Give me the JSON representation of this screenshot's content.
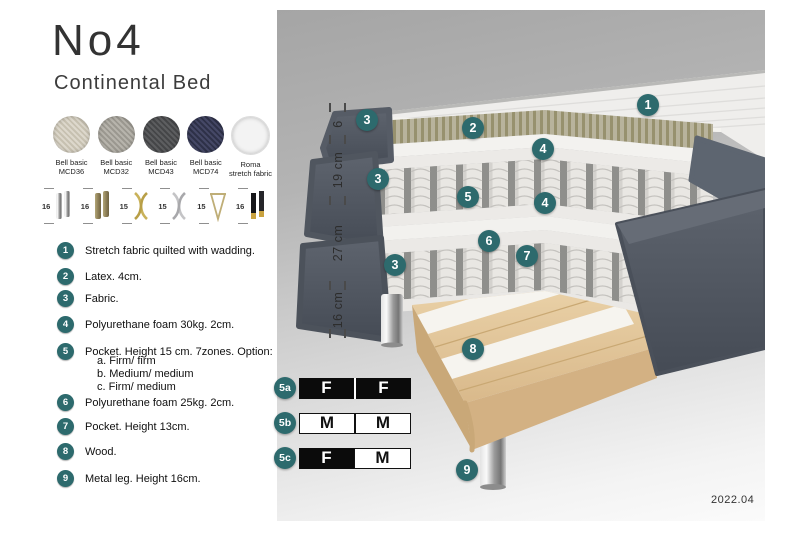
{
  "header": {
    "title": "No4",
    "subtitle": "Continental Bed"
  },
  "fabrics": [
    {
      "line1": "Bell basic",
      "line2": "MCD36",
      "color": "#d9d4c9"
    },
    {
      "line1": "Bell basic",
      "line2": "MCD32",
      "color": "#b2afa8"
    },
    {
      "line1": "Bell basic",
      "line2": "MCD43",
      "color": "#57585a"
    },
    {
      "line1": "Bell basic",
      "line2": "MCD74",
      "color": "#3f4259"
    },
    {
      "line1": "Roma",
      "line2": "stretch fabric",
      "color": "#f3f3f3"
    }
  ],
  "legs": [
    {
      "height": "16",
      "type": "chrome cylinder legs"
    },
    {
      "height": "16",
      "type": "wood cylinder legs"
    },
    {
      "height": "15",
      "type": "gold cross legs"
    },
    {
      "height": "15",
      "type": "silver cross legs"
    },
    {
      "height": "15",
      "type": "hairpin legs"
    },
    {
      "height": "16",
      "type": "black legs with brass tip"
    }
  ],
  "legend": {
    "items": [
      {
        "num": "1",
        "text": "Stretch fabric quilted with wadding."
      },
      {
        "num": "2",
        "text": "Latex. 4cm."
      },
      {
        "num": "3",
        "text": "Fabric."
      },
      {
        "num": "4",
        "text": "Polyurethane foam 30kg. 2cm."
      },
      {
        "num": "5",
        "text": "Pocket. Height 15 cm. 7zones. Option:",
        "options": [
          "a. Firm/ firm",
          "b. Medium/ medium",
          "c. Firm/ medium"
        ]
      },
      {
        "num": "6",
        "text": "Polyurethane foam 25kg. 2cm."
      },
      {
        "num": "7",
        "text": "Pocket. Height 13cm."
      },
      {
        "num": "8",
        "text": "Wood."
      },
      {
        "num": "9",
        "text": "Metal leg. Height 16cm."
      }
    ]
  },
  "illustration": {
    "dimensions": [
      "6",
      "19 cm",
      "27 cm",
      "16 cm"
    ],
    "callouts": [
      "1",
      "3",
      "2",
      "4",
      "3",
      "5",
      "4",
      "6",
      "7",
      "3",
      "8",
      "9"
    ],
    "date": "2022.04"
  },
  "firmness": {
    "rows": [
      {
        "label": "5a",
        "cells": [
          {
            "text": "F",
            "style": "dark"
          },
          {
            "text": "F",
            "style": "dark"
          }
        ]
      },
      {
        "label": "5b",
        "cells": [
          {
            "text": "M",
            "style": "light"
          },
          {
            "text": "M",
            "style": "light"
          }
        ]
      },
      {
        "label": "5c",
        "cells": [
          {
            "text": "F",
            "style": "dark"
          },
          {
            "text": "M",
            "style": "light"
          }
        ]
      }
    ]
  },
  "colors": {
    "accent_teal": "#2d6a6d",
    "slate_fabric": "#555b65",
    "latex": "#b6b19a",
    "wood": "#e0c499"
  }
}
